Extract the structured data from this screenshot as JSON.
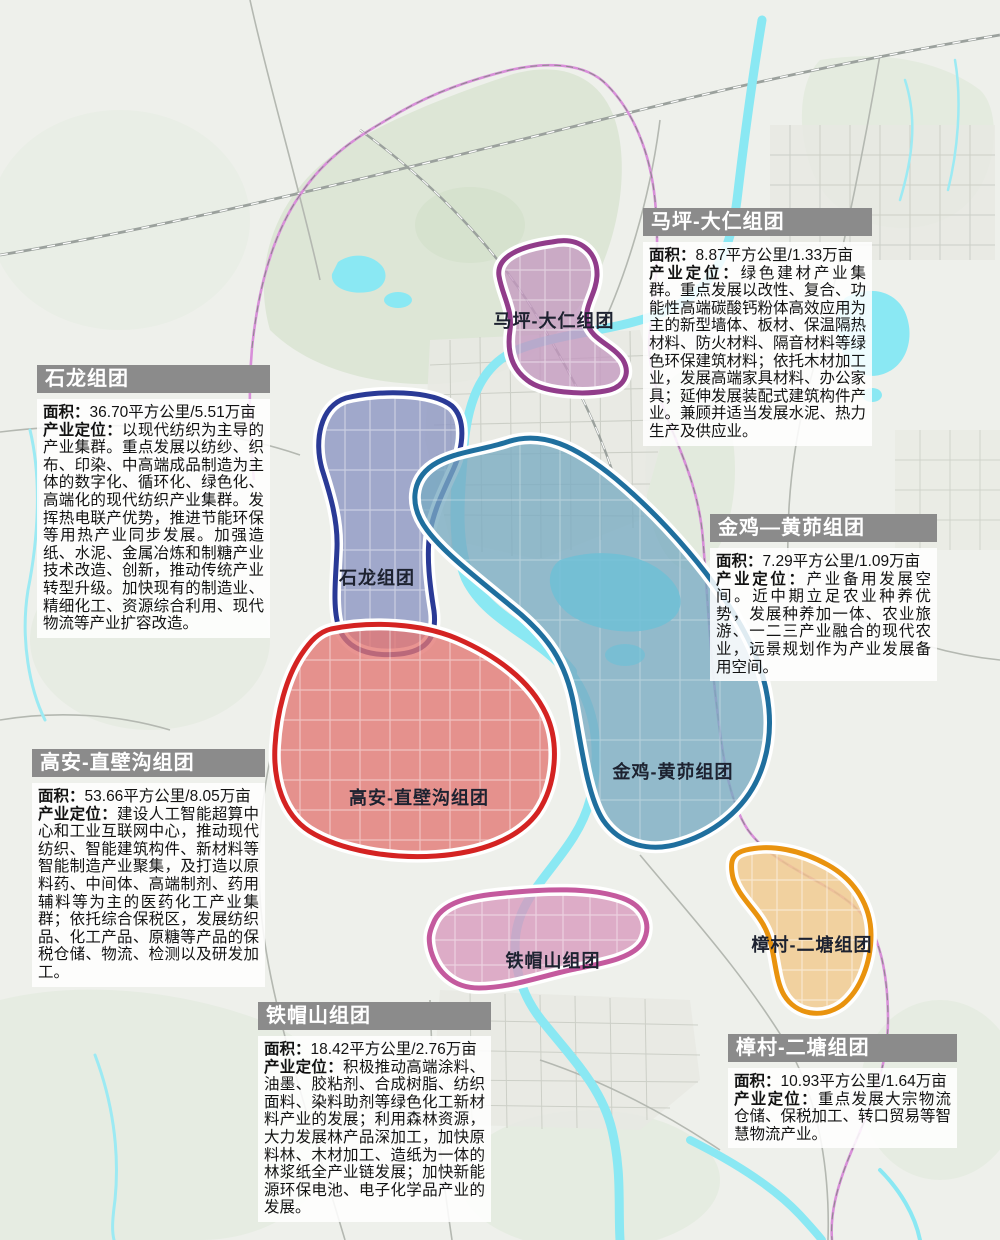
{
  "colors": {
    "map_background": "#eef0eb",
    "vegetation": "#d9e4d2",
    "urban_patch": "#e8e9e3",
    "road": "#b4b8b1",
    "railway": "#9ba19d",
    "river": "#8ae8f3",
    "lake_dark": "#6fc0d6",
    "admin_boundary": "#d88fd9",
    "panel_header_bg": "#8b8b8b",
    "panel_header_text": "#ffffff",
    "panel_body_bg": "rgba(255,255,255,0.86)"
  },
  "zones": [
    {
      "id": "maping_daren",
      "map_label": "马坪-大仁组团",
      "fill": "#c499c0",
      "stroke": "#913c8a"
    },
    {
      "id": "shilong",
      "map_label": "石龙组团",
      "fill": "#8a93c2",
      "stroke": "#2a3a96"
    },
    {
      "id": "jinji_huangmao",
      "map_label": "金鸡-黄茆组团",
      "fill": "#79abc2",
      "stroke": "#1f6f9e"
    },
    {
      "id": "gaoan_zhibigou",
      "map_label": "高安-直壁沟组团",
      "fill": "#e37672",
      "stroke": "#d42322"
    },
    {
      "id": "tiemaoshan",
      "map_label": "铁帽山组团",
      "fill": "#d898bd",
      "stroke": "#c45a9e"
    },
    {
      "id": "zhangcun_ertang",
      "map_label": "樟村-二塘组团",
      "fill": "#f2c98e",
      "stroke": "#e9930e"
    }
  ],
  "panels": [
    {
      "id": "maping_daren",
      "title": "马坪-大仁组团",
      "area_label": "面积：",
      "area_value": "8.87平方公里/1.33万亩",
      "positioning_label": "产业定位：",
      "positioning_value": "绿色建材产业集群。重点发展以改性、复合、功能性高端碳酸钙粉体高效应用为主的新型墙体、板材、保温隔热材料、防火材料、隔音材料等绿色环保建筑材料；依托木材加工业，发展高端家具材料、办公家具；延伸发展装配式建筑构件产业。兼顾并适当发展水泥、热力生产及供应业。"
    },
    {
      "id": "shilong",
      "title": "石龙组团",
      "area_label": "面积：",
      "area_value": "36.70平方公里/5.51万亩",
      "positioning_label": "产业定位：",
      "positioning_value": "以现代纺织为主导的产业集群。重点发展以纺纱、织布、印染、中高端成品制造为主体的数字化、循环化、绿色化、高端化的现代纺织产业集群。发挥热电联产优势，推进节能环保等用热产业同步发展。加强造纸、水泥、金属冶炼和制糖产业技术改造、创新，推动传统产业转型升级。加快现有的制造业、精细化工、资源综合利用、现代物流等产业扩容改造。"
    },
    {
      "id": "jinji_huangmao",
      "title": "金鸡—黄茆组团",
      "area_label": "面积：",
      "area_value": "7.29平方公里/1.09万亩",
      "positioning_label": "产业定位：",
      "positioning_value": "产业备用发展空间。近中期立足农业种养优势，发展种养加一体、农业旅游、一二三产业融合的现代农业，远景规划作为产业发展备用空间。"
    },
    {
      "id": "gaoan_zhibigou",
      "title": "高安-直壁沟组团",
      "area_label": "面积：",
      "area_value": "53.66平方公里/8.05万亩",
      "positioning_label": "产业定位：",
      "positioning_value": "建设人工智能超算中心和工业互联网中心，推动现代纺织、智能建筑构件、新材料等智能制造产业聚集，及打造以原料药、中间体、高端制剂、药用辅料等为主的医药化工产业集群；依托综合保税区，发展纺织品、化工产品、原糖等产品的保税仓储、物流、检测以及研发加工。"
    },
    {
      "id": "tiemaoshan",
      "title": "铁帽山组团",
      "area_label": "面积：",
      "area_value": "18.42平方公里/2.76万亩",
      "positioning_label": "产业定位：",
      "positioning_value": "积极推动高端涂料、油墨、胶粘剂、合成树脂、纺织面料、染料助剂等绿色化工新材料产业的发展；利用森林资源，大力发展林产品深加工，加快原料林、木材加工、造纸为一体的林浆纸全产业链发展；加快新能源环保电池、电子化学品产业的发展。"
    },
    {
      "id": "zhangcun_ertang",
      "title": "樟村-二塘组团",
      "area_label": "面积：",
      "area_value": "10.93平方公里/1.64万亩",
      "positioning_label": "产业定位：",
      "positioning_value": "重点发展大宗物流仓储、保税加工、转口贸易等智慧物流产业。"
    }
  ]
}
